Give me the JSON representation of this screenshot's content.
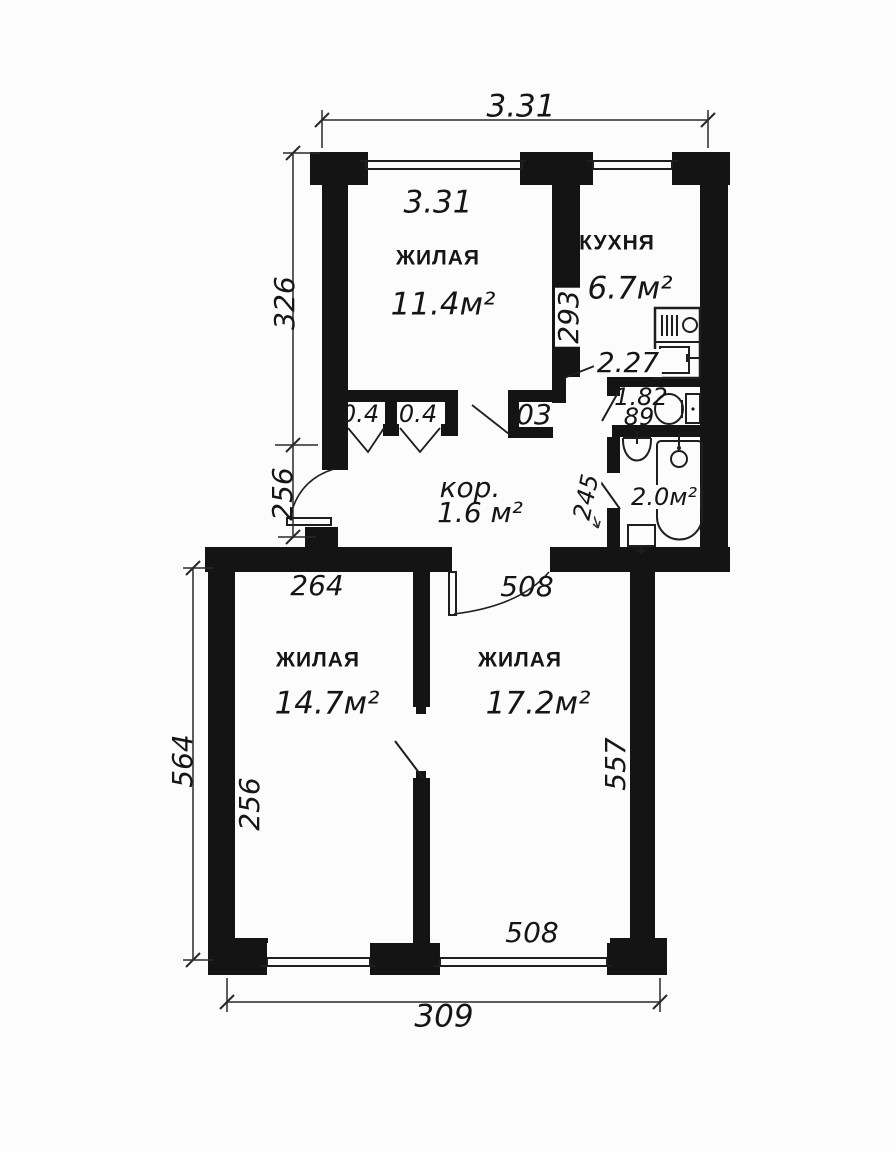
{
  "floor_plan": {
    "rooms": {
      "living_top": {
        "name": "ЖИЛАЯ",
        "area": "11.4м²",
        "width_label": "3.31"
      },
      "kitchen": {
        "name": "КУХНЯ",
        "area": "6.7м²",
        "depth_label": "293",
        "width_label": "2.27"
      },
      "wc": {
        "length_label": "1.82",
        "width_label": "89"
      },
      "bathroom": {
        "area": "2.0м²",
        "depth_label": "245"
      },
      "corridor": {
        "name": "кор.",
        "area": "1.6 м²"
      },
      "closet_left": {
        "area": "0.4"
      },
      "closet_mid": {
        "area": "0.4"
      },
      "closet_hall": {
        "area": "03"
      },
      "living_left": {
        "name": "ЖИЛАЯ",
        "area": "14.7м²",
        "width_label": "264",
        "depth_label": "256"
      },
      "living_right": {
        "name": "ЖИЛАЯ",
        "area": "17.2м²",
        "depth_label": "557",
        "window_label": "508"
      }
    },
    "dimensions": {
      "top_overall": "3.31",
      "left_upper": "326",
      "left_entry": "256",
      "left_lower_overall": "564",
      "bottom_overall": "309",
      "hall_door": "508"
    },
    "colors": {
      "wall": "#141414",
      "background": "#fcfcfc",
      "line": "#1e1e1e"
    }
  }
}
